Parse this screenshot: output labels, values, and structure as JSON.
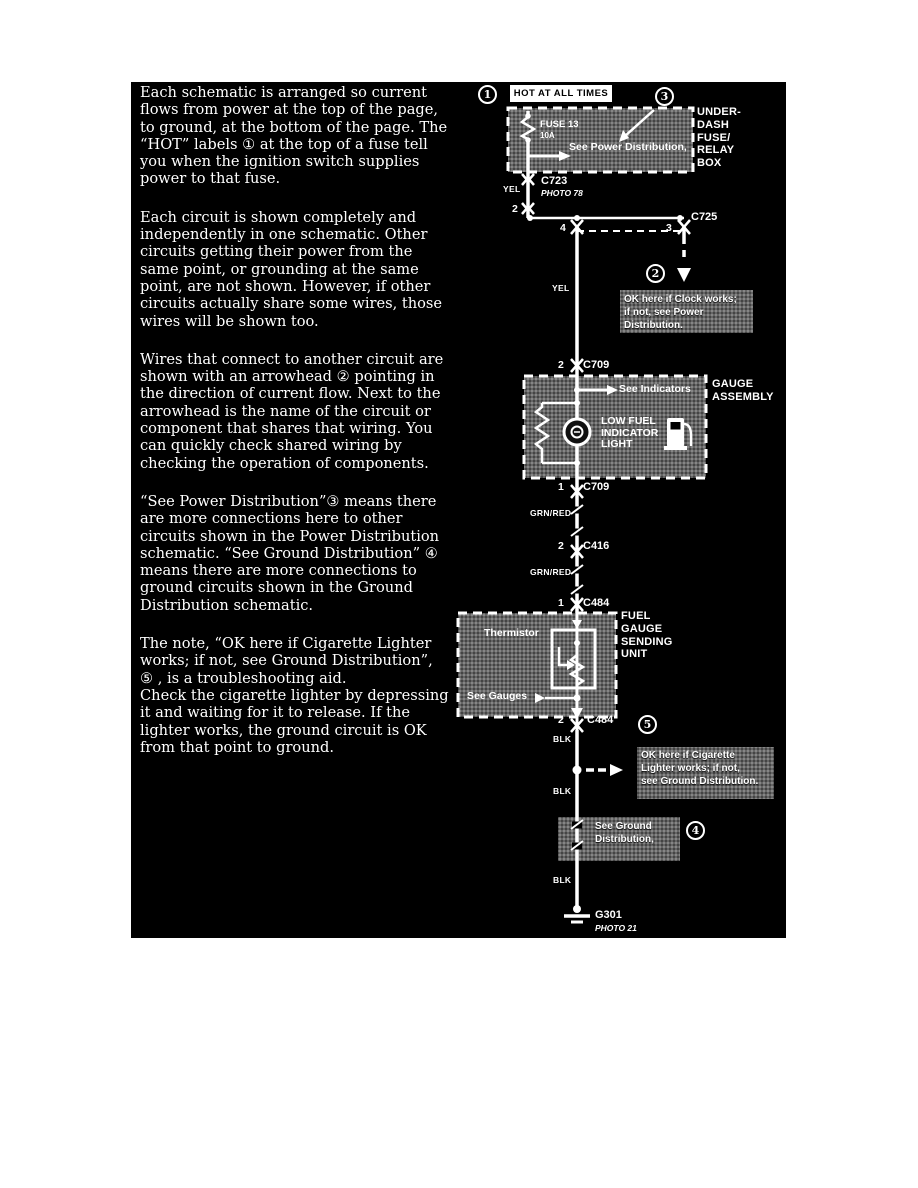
{
  "colors": {
    "panel_bg": "#000000",
    "ink": "#ffffff",
    "note_bg": "#6b6b6b"
  },
  "article": {
    "paragraphs": [
      "Each schematic is arranged so current\nflows from power at the top of the page,\nto ground, at the bottom of the page. The\n“HOT” labels ①  at the top of a fuse tell\nyou when the ignition switch supplies\npower to that fuse.",
      "Each circuit is shown completely and\nindependently in one schematic. Other\ncircuits getting their power from the\nsame point, or grounding at the same\npoint, are not shown. However, if other\ncircuits actually share some wires, those\nwires will be  shown too.",
      "Wires that connect to another circuit are\nshown with an arrowhead ②  pointing in\nthe direction of current flow. Next to the\narrowhead is the name of the circuit or\ncomponent that shares that wiring. You\ncan quickly check shared wiring by\nchecking the operation of components.",
      "“See Power Distribution”③  means there\nare more connections here to other\ncircuits shown in the Power Distribution\nschematic. “See Ground Distribution” ④\nmeans there are more connections to\nground circuits shown in the Ground\nDistribution schematic.",
      "The note, “OK here if Cigarette Lighter\nworks; if not, see Ground Distribution”,\n⑤ , is a troubleshooting aid.\nCheck the cigarette lighter by depressing\nit and waiting for it to release. If the\nlighter works, the ground circuit is OK\nfrom that point to ground."
    ]
  },
  "schematic": {
    "callouts": {
      "c1": "1",
      "c2": "2",
      "c3": "3",
      "c4": "4",
      "c5": "5"
    },
    "hot_label": "HOT AT ALL TIMES",
    "fusebox": {
      "fuse": "FUSE 13",
      "rating": "10A",
      "see": "See Power Distribution,",
      "label": "UNDER-\nDASH\nFUSE/\nRELAY\nBOX"
    },
    "c723": {
      "name": "C723",
      "photo": "PHOTO 78",
      "wire": "YEL",
      "pin": "2"
    },
    "c725": {
      "name": "C725",
      "pin_left": "4",
      "pin_right": "3"
    },
    "clock_note": "OK here if Clock works;\nif not, see Power\nDistribution.",
    "yel2": "YEL",
    "c709_top": {
      "pin": "2",
      "name": "C709"
    },
    "gauge_assembly": {
      "label": "GAUGE\nASSEMBLY",
      "see_indicators": "See Indicators",
      "lamp": "LOW FUEL\nINDICATOR\nLIGHT"
    },
    "c709_bot": {
      "pin": "1",
      "name": "C709"
    },
    "grnred1": "GRN/RED",
    "c416": {
      "pin": "2",
      "name": "C416"
    },
    "grnred2": "GRN/RED",
    "c484_top": {
      "pin": "1",
      "name": "C484"
    },
    "sending_unit": {
      "label": "FUEL\nGAUGE\nSENDING\nUNIT",
      "thermistor": "Thermistor",
      "see_gauges": "See Gauges"
    },
    "c484_bot": {
      "pin": "2",
      "name": "C484"
    },
    "blk1": "BLK",
    "cig_note": "OK here if Cigarette\nLighter works; if not,\nsee Ground Distribution.",
    "blk2": "BLK",
    "ground_note": "See Ground\nDistribution,",
    "blk3": "BLK",
    "ground": {
      "name": "G301",
      "photo": "PHOTO 21"
    }
  }
}
